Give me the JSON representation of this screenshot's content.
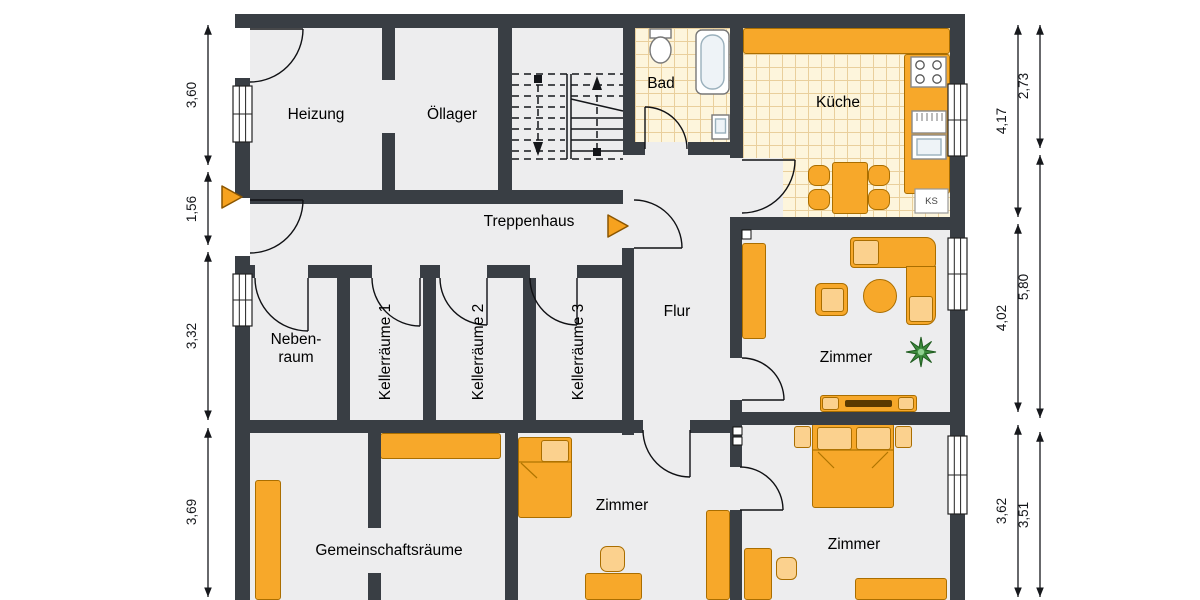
{
  "type": "floor-plan",
  "rooms": {
    "heizung": "Heizung",
    "oellager": "Öllager",
    "bad": "Bad",
    "kueche": "Küche",
    "treppenhaus": "Treppenhaus",
    "nebenraum": "Neben-\nraum",
    "keller1": "Kellerräume 1",
    "keller2": "Kellerräume 2",
    "keller3": "Kellerräume 3",
    "flur": "Flur",
    "zimmer_wohnen": "Zimmer",
    "gemeinschaft": "Gemeinschaftsräume",
    "zimmer_mitte": "Zimmer",
    "zimmer_unten": "Zimmer"
  },
  "kitchen": {
    "fridge_label": "KS"
  },
  "dims": {
    "left": [
      "3,60",
      "1,56",
      "3,32",
      "3,69"
    ],
    "right_inner": [
      "4,17",
      "4,02",
      "3,62"
    ],
    "right_outer": [
      "2,73",
      "5,80",
      "3,51"
    ]
  },
  "colors": {
    "wall": "#393e44",
    "floor": "#ededee",
    "tile_floor": "#fdf5dc",
    "tile_grid": "#e9cf9c",
    "furniture": "#f7a82a",
    "furniture_light": "#fbd18e",
    "furniture_border": "#aa6e00",
    "entrance_arrow": "#f6a21f",
    "dimension_text": "#14161a"
  }
}
